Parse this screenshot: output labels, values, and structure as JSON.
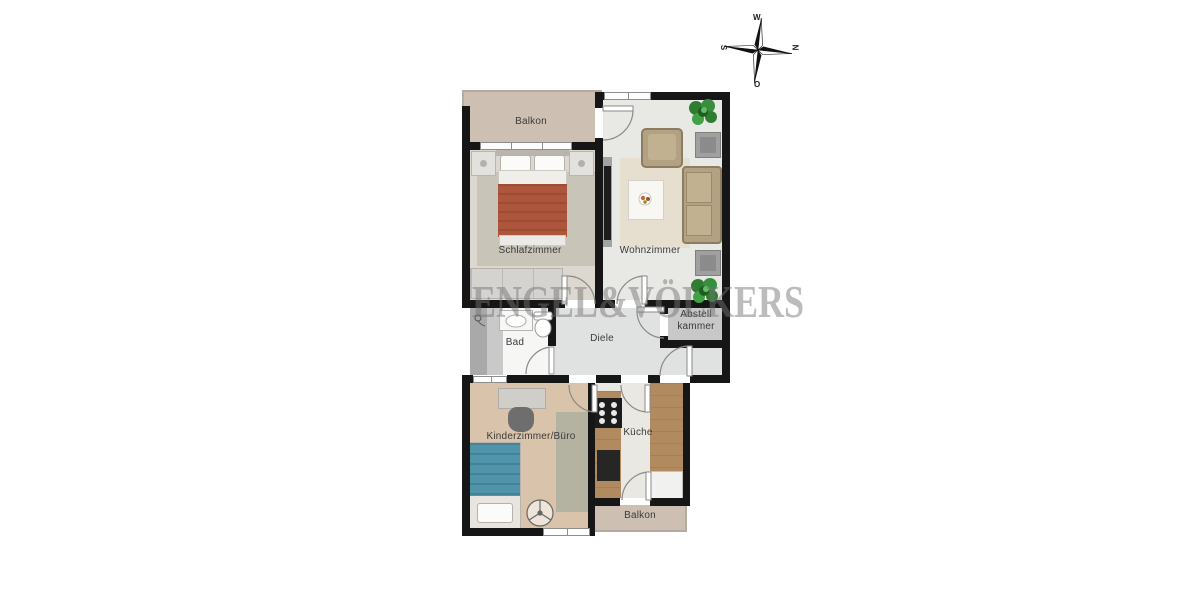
{
  "watermark": "ENGEL&VÖLKERS",
  "compass": {
    "top": "W",
    "right": "N",
    "bottom": "O",
    "left": "S"
  },
  "rooms": {
    "balkon_top": {
      "label": "Balkon"
    },
    "schlafzimmer": {
      "label": "Schlafzimmer"
    },
    "wohnzimmer": {
      "label": "Wohnzimmer"
    },
    "bad": {
      "label": "Bad"
    },
    "diele": {
      "label": "Diele"
    },
    "abstellkammer": {
      "line1": "Abstell",
      "line2": "kammer"
    },
    "kinderzimmer_buero": {
      "label": "Kinderzimmer/Büro"
    },
    "kueche": {
      "label": "Küche"
    },
    "balkon_bottom": {
      "label": "Balkon"
    }
  },
  "icons": {
    "compass-rose": "four-point star, W top / N right / O bottom / S left",
    "plant": "green foliage cluster",
    "ceiling-fan": "circle with three blades",
    "shower-head": "small circle with hose"
  },
  "colors": {
    "wall": "#161616",
    "balcony": "#cdc0b2",
    "bedroom_floor": "#dcd7cf",
    "living_floor": "#e8e8e5",
    "hall_floor": "#e0e2e1",
    "storage_floor": "#c8c8c8",
    "kids_floor": "#d9c3ab",
    "kitchen_wood": "#b28a5f",
    "bed_blanket": "#ae563b",
    "kids_bed_blanket": "#4f94aa",
    "sofa_tan": "#b3a183",
    "plant_green": "#388e3c",
    "watermark_gray": "#737373"
  }
}
